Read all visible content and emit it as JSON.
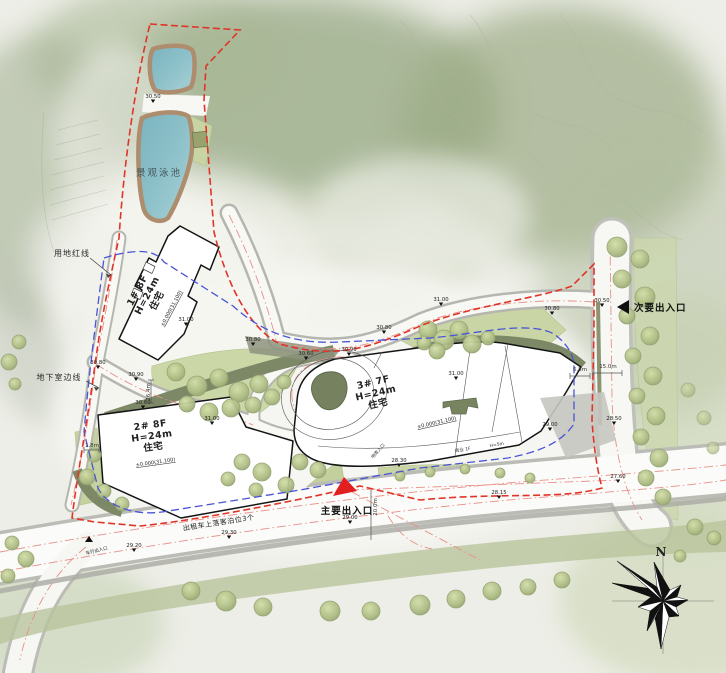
{
  "colors": {
    "boundary_red": "#e03428",
    "basement_blue": "#4a55d6",
    "road_center_pink": "#e89088",
    "pool_teal": "#85bcc6",
    "entrance_red": "#e31e1e",
    "lawn_green": "#ccd7a8",
    "olive_band": "#7c8866"
  },
  "boundary": {
    "label": "用地红线"
  },
  "basement": {
    "label": "地下室边线"
  },
  "pool": {
    "label": "景观泳池"
  },
  "buildings": [
    {
      "line1": "1# 8F",
      "line2": "H=24m",
      "line3": "住宅",
      "datum": "±0.000(31.100)"
    },
    {
      "line1": "2# 8F",
      "line2": "H=24m",
      "line3": "住宅",
      "datum": "±0.000(31.100)"
    },
    {
      "line1": "3# 7F",
      "line2": "H=24m",
      "line3": "住宅",
      "datum": "±0.000(31.100)"
    }
  ],
  "entrances": {
    "main": "主要出入口",
    "secondary": "次要出入口",
    "vehicle": "车行出入口"
  },
  "notes": {
    "taxi": "出租车上落客泊位3个",
    "commercial": "商业 1F",
    "commercial_h": "H=5m",
    "garage": "地库入口"
  },
  "spot_elevations": [
    "30.50",
    "31.00",
    "30.80",
    "30.60",
    "30.90",
    "30.80",
    "31.00",
    "30.80",
    "30.50",
    "31.00",
    "31.00",
    "30.80",
    "30.90",
    "30.60",
    "29.00",
    "28.50",
    "27.60",
    "28.15",
    "28.30",
    "29.00",
    "29.30",
    "29.20"
  ],
  "dimensions": [
    "26.4m",
    "1.8m",
    "6.8m",
    "15.0m",
    "20.0m"
  ],
  "compass": {
    "north": "N"
  }
}
